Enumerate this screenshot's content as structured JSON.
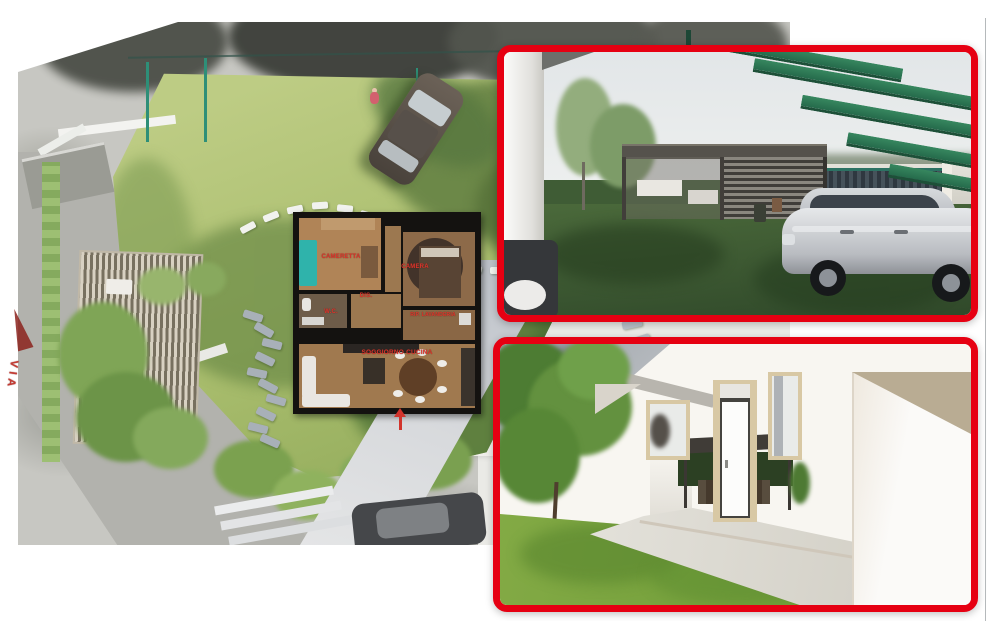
{
  "site_plan": {
    "street_label": "VIA",
    "floor_plan": {
      "rooms": [
        {
          "name": "cameretta",
          "label": "CAMERETTA"
        },
        {
          "name": "camera",
          "label": "CAMERA"
        },
        {
          "name": "disimpegno",
          "label": "DIS."
        },
        {
          "name": "wc",
          "label": "W.C."
        },
        {
          "name": "ripostiglio-lavanderia",
          "label": "RIP. LAVANDERIA"
        },
        {
          "name": "soggiorno-cucina",
          "label": "SOGGIORNO CUCINA"
        }
      ]
    }
  },
  "colors": {
    "inset_border_red": "#e60012",
    "room_label_red": "#e0342b",
    "pergola_beam_green": "#2e7a5c",
    "lawn_render_light": "#b6c77c",
    "lawn_render_dark": "#3f5c35",
    "fence_teal": "#2e8f78"
  }
}
